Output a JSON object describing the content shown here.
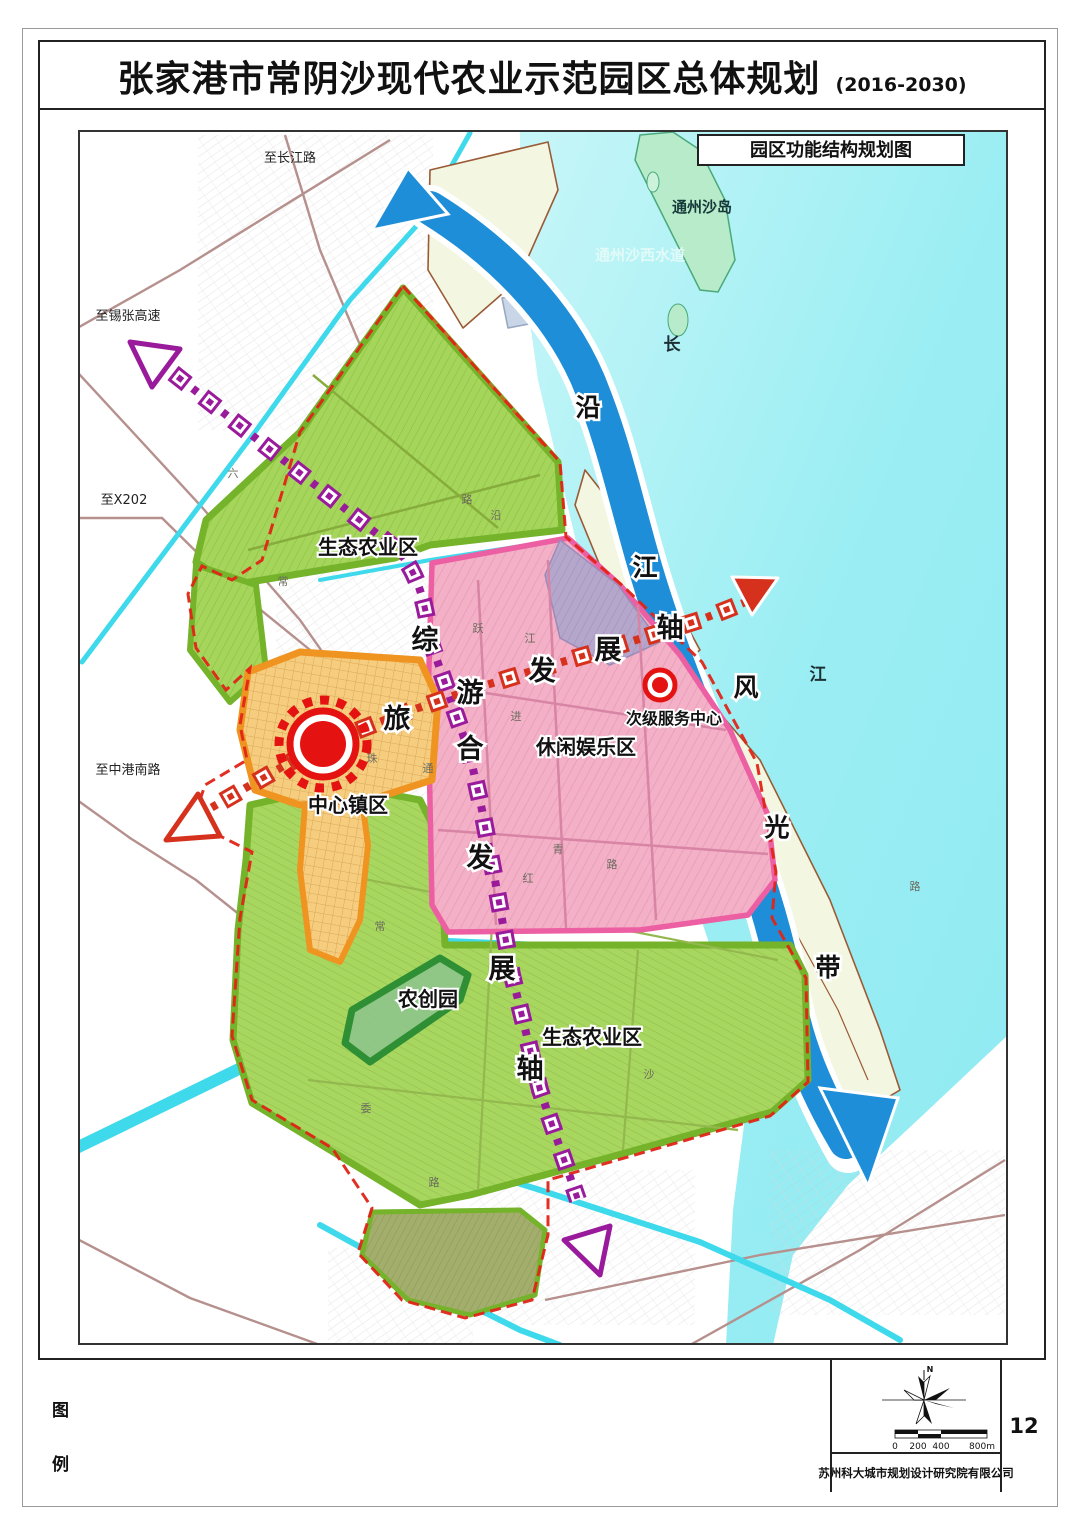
{
  "page": {
    "title": "张家港市常阴沙现代农业示范园区总体规划",
    "subtitle": "(2016-2030)",
    "page_number": "12",
    "company": "苏州科大城市规划设计研究院有限公司"
  },
  "map": {
    "title": "园区功能结构规划图",
    "labels": [
      {
        "t": "生态农业区",
        "x": 290,
        "y": 424,
        "c": "zone",
        "n": "zone-label-eco-agriculture-north"
      },
      {
        "t": "休闲娱乐区",
        "x": 508,
        "y": 624,
        "c": "zone",
        "n": "zone-label-leisure-entertainment"
      },
      {
        "t": "中心镇区",
        "x": 270,
        "y": 682,
        "c": "zone",
        "n": "zone-label-central-town"
      },
      {
        "t": "次级服务中心",
        "x": 596,
        "y": 594,
        "c": "zonesm",
        "n": "zone-label-secondary-service-center"
      },
      {
        "t": "农创园",
        "x": 350,
        "y": 876,
        "c": "zone",
        "n": "zone-label-agri-innovation-park"
      },
      {
        "t": "生态农业区",
        "x": 514,
        "y": 914,
        "c": "zone",
        "n": "zone-label-eco-agriculture-south"
      },
      {
        "t": "至长江路",
        "x": 212,
        "y": 32,
        "c": "road",
        "n": "road-label-to-changjiang-road"
      },
      {
        "t": "至锡张高速",
        "x": 50,
        "y": 190,
        "c": "road",
        "n": "road-label-to-xizhang-expressway"
      },
      {
        "t": "至X202",
        "x": 46,
        "y": 374,
        "c": "road",
        "n": "road-label-to-x202"
      },
      {
        "t": "至中港南路",
        "x": 50,
        "y": 644,
        "c": "road",
        "n": "road-label-to-zhonggang-south-road"
      },
      {
        "t": "通州沙岛",
        "x": 624,
        "y": 82,
        "c": "water",
        "n": "water-label-tongzhousha-island"
      },
      {
        "t": "通州沙西水道",
        "x": 562,
        "y": 130,
        "c": "waterlight",
        "n": "water-label-tongzhousha-west-channel"
      },
      {
        "t": "长",
        "x": 594,
        "y": 220,
        "c": "river",
        "n": "river-name-char-chang"
      },
      {
        "t": "江",
        "x": 740,
        "y": 550,
        "c": "river",
        "n": "river-name-char-jiang"
      },
      {
        "t": "沿",
        "x": 510,
        "y": 286,
        "c": "belt",
        "n": "belt-char-yan"
      },
      {
        "t": "江",
        "x": 567,
        "y": 446,
        "c": "belt",
        "n": "belt-char-jiang"
      },
      {
        "t": "风",
        "x": 668,
        "y": 566,
        "c": "belt",
        "n": "belt-char-feng"
      },
      {
        "t": "光",
        "x": 699,
        "y": 706,
        "c": "belt",
        "n": "belt-char-guang"
      },
      {
        "t": "带",
        "x": 750,
        "y": 846,
        "c": "belt",
        "n": "belt-char-dai"
      },
      {
        "t": "综",
        "x": 347,
        "y": 519,
        "c": "axis",
        "n": "axis-char-zong"
      },
      {
        "t": "合",
        "x": 392,
        "y": 628,
        "c": "axis",
        "n": "axis-char-he"
      },
      {
        "t": "发",
        "x": 402,
        "y": 737,
        "c": "axis",
        "n": "axis-char-fa-vertical"
      },
      {
        "t": "展",
        "x": 424,
        "y": 848,
        "c": "axis",
        "n": "axis-char-zhan-vertical"
      },
      {
        "t": "轴",
        "x": 452,
        "y": 948,
        "c": "axis",
        "n": "axis-char-zhou-vertical"
      },
      {
        "t": "旅",
        "x": 319,
        "y": 598,
        "c": "axis",
        "n": "axis-char-lv"
      },
      {
        "t": "游",
        "x": 392,
        "y": 572,
        "c": "axis",
        "n": "axis-char-you"
      },
      {
        "t": "发",
        "x": 464,
        "y": 550,
        "c": "axis",
        "n": "axis-char-fa-horizontal"
      },
      {
        "t": "展",
        "x": 530,
        "y": 529,
        "c": "axis",
        "n": "axis-char-zhan-horizontal"
      },
      {
        "t": "轴",
        "x": 592,
        "y": 507,
        "c": "axis",
        "n": "axis-char-zhou-horizontal"
      }
    ],
    "road_chars": [
      {
        "t": "六",
        "x": 155,
        "y": 347
      },
      {
        "t": "常",
        "x": 205,
        "y": 455
      },
      {
        "t": "路",
        "x": 389,
        "y": 373
      },
      {
        "t": "沿",
        "x": 418,
        "y": 389
      },
      {
        "t": "跃",
        "x": 400,
        "y": 502
      },
      {
        "t": "江",
        "x": 452,
        "y": 512
      },
      {
        "t": "进",
        "x": 438,
        "y": 590
      },
      {
        "t": "红",
        "x": 450,
        "y": 752
      },
      {
        "t": "路",
        "x": 534,
        "y": 738
      },
      {
        "t": "青",
        "x": 480,
        "y": 723
      },
      {
        "t": "沙",
        "x": 571,
        "y": 948
      },
      {
        "t": "委",
        "x": 288,
        "y": 982
      },
      {
        "t": "路",
        "x": 356,
        "y": 1056
      },
      {
        "t": "珠",
        "x": 294,
        "y": 632
      },
      {
        "t": "通",
        "x": 350,
        "y": 642
      },
      {
        "t": "常",
        "x": 302,
        "y": 800
      },
      {
        "t": "路",
        "x": 837,
        "y": 760
      }
    ]
  },
  "legend": {
    "char_top": "图",
    "char_bottom": "例",
    "north": "N",
    "scale_ticks": [
      "0",
      "200",
      "400",
      "800m"
    ]
  },
  "colors": {
    "river_water": "#9beef3",
    "channel_blue": "#1e8ed8",
    "eco_green": "#a5d65b",
    "eco_green_border": "#74b32a",
    "leisure_pink": "#f3b0c6",
    "leisure_pink_border": "#ec5fa2",
    "town_orange": "#f6cd7e",
    "town_orange_border": "#ef9421",
    "axis_purple": "#991b9b",
    "axis_red": "#d5311d",
    "boundary_red": "#e02417",
    "canal_cyan": "#3fd9ec",
    "island_mint": "#b7ebc9",
    "polder": "#f3f7e2"
  }
}
